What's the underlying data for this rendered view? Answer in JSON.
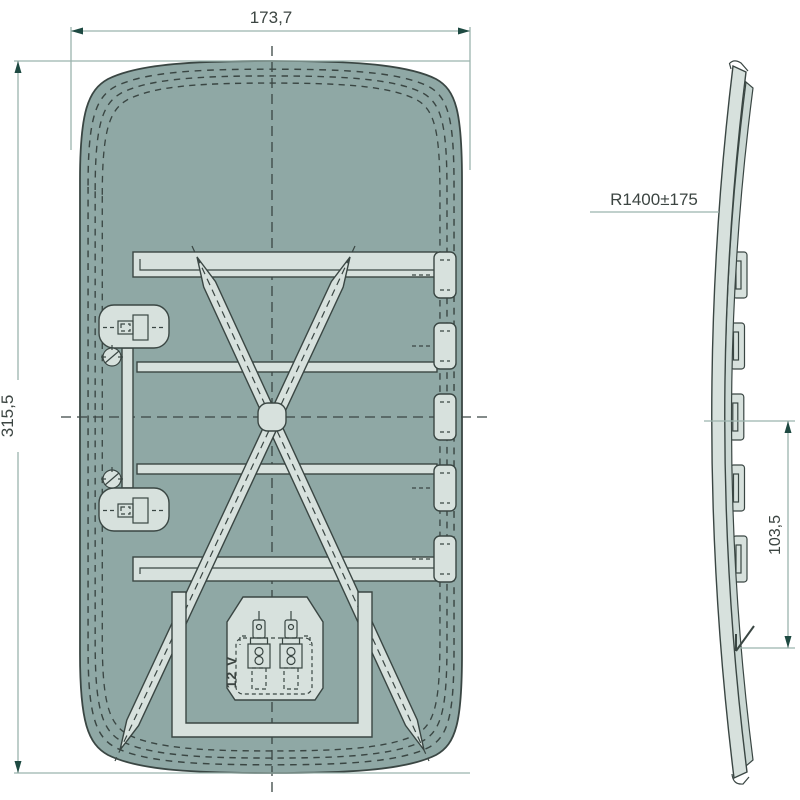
{
  "drawing": {
    "views": {
      "front": "front-view",
      "side": "side-profile-view"
    },
    "dimensions": {
      "overall_width": "173,7",
      "overall_height": "315,5",
      "glass_radius": "R1400±175",
      "clip_field_height": "103,5"
    },
    "labels": {
      "voltage": "12 V"
    },
    "counts": {
      "right_clips": 5,
      "left_clip_housings": 2,
      "heater_terminals": 2
    }
  },
  "colors": {
    "glass_fill": "#8FA8A5",
    "part_light": "#D7E1DD",
    "outline": "#3A4643",
    "dimension_line": "#9BB3AD",
    "arrow_fill": "#1E4A42",
    "text_color": "#3C4542",
    "background": "#FFFFFF"
  }
}
